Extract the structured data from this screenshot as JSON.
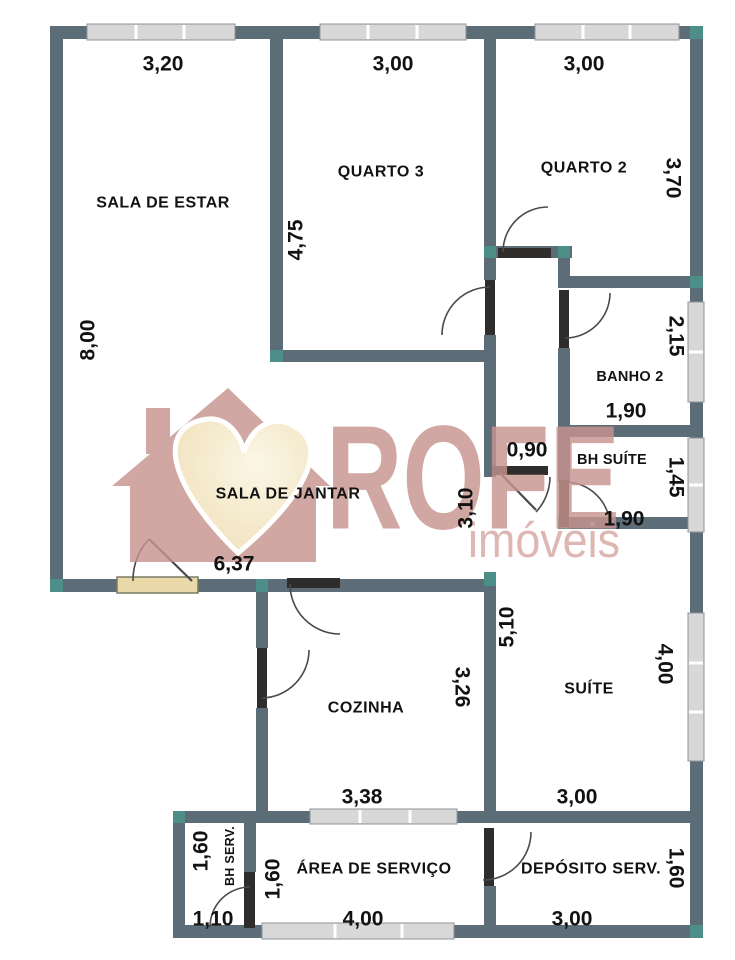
{
  "plan": {
    "rooms": {
      "sala_estar": "SALA DE ESTAR",
      "quarto3": "QUARTO 3",
      "quarto2": "QUARTO 2",
      "banho2": "BANHO 2",
      "bh_suite": "BH SUÍTE",
      "sala_jantar": "SALA DE JANTAR",
      "cozinha": "COZINHA",
      "suite": "SUÍTE",
      "area_servico": "ÁREA DE SERVIÇO",
      "deposito": "DEPÓSITO SERV.",
      "bh_serv": "BH SERV."
    },
    "dims": {
      "sala_top": "3,20",
      "quarto3_top": "3,00",
      "quarto2_top": "3,00",
      "quarto2_right": "3,70",
      "sala_left": "8,00",
      "quarto3_height": "4,75",
      "banho2_right": "2,15",
      "banho2_width": "1,90",
      "hall_width": "0,90",
      "bh_suite_right": "1,45",
      "bh_suite_width": "1,90",
      "jantar_right": "3,10",
      "jantar_width": "6,37",
      "suite_left": "5,10",
      "cozinha_right": "3,26",
      "suite_right": "4,00",
      "cozinha_width": "3,38",
      "suite_width": "3,00",
      "bh_serv_height": "1,60",
      "area_height": "1,60",
      "bh_serv_width": "1,10",
      "area_width": "4,00",
      "deposito_right": "1,60",
      "deposito_width": "3,00"
    }
  },
  "watermark": {
    "brand": "ROFE",
    "tagline": "imóveis"
  },
  "colors": {
    "wall": "#5d6d78",
    "corner_accent": "#4e8e88",
    "window_fill": "#d8d8d8",
    "door_leaf": "#2e2d2b",
    "entrance_door": "#e9d9a8",
    "watermark_pink": "#c69490",
    "watermark_text_pink": "#d7a7a2",
    "heart_cream": "#f5ead0",
    "label_color": "#121212"
  }
}
